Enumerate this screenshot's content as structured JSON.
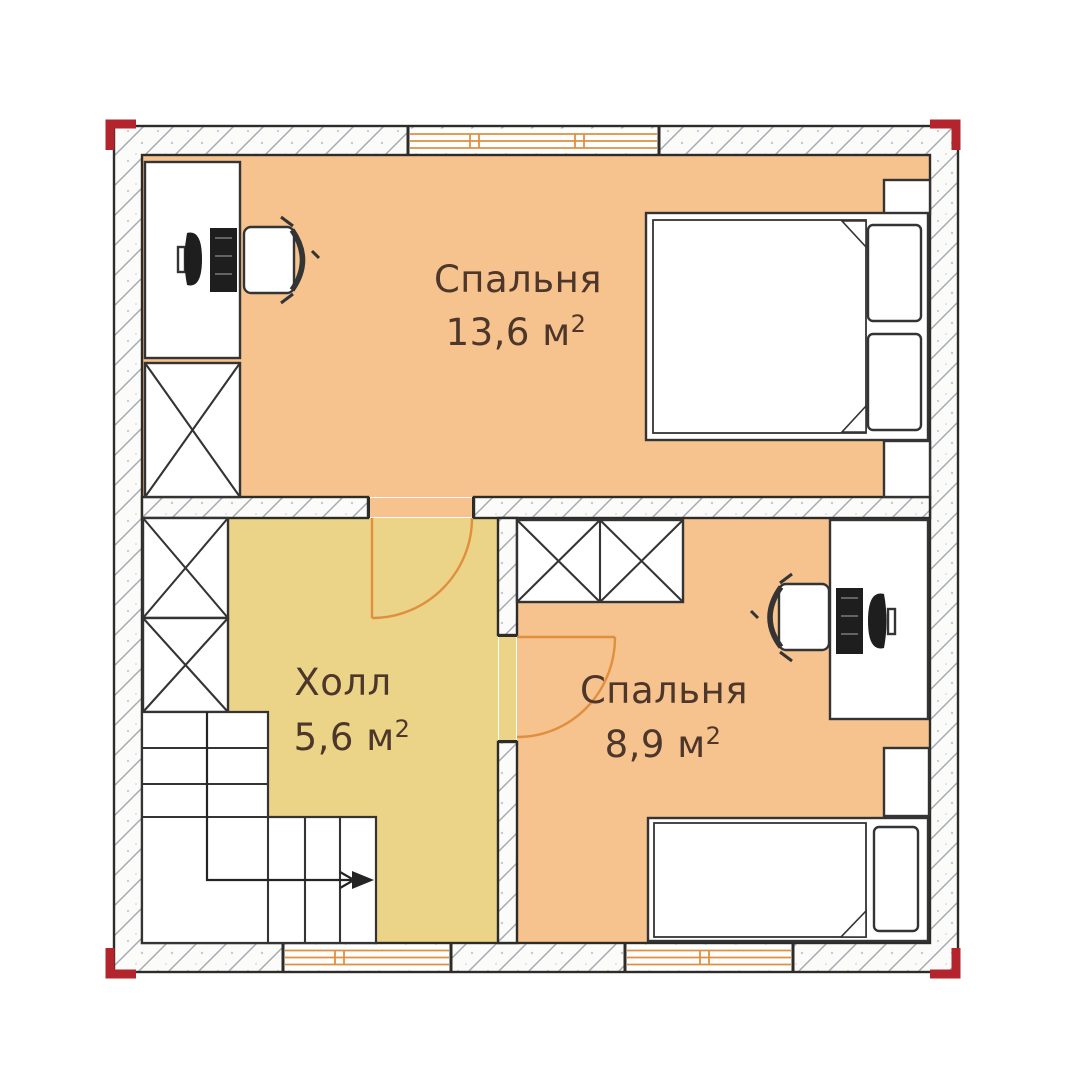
{
  "rooms": {
    "bedroom1": {
      "name": "Спальня",
      "area": "13,6 м",
      "area_sup": "2"
    },
    "hall": {
      "name": "Холл",
      "area": "5,6 м",
      "area_sup": "2"
    },
    "bedroom2": {
      "name": "Спальня",
      "area": "8,9 м",
      "area_sup": "2"
    }
  },
  "colors": {
    "room_fill": "#f6c28d",
    "hall_fill": "#ebd487",
    "accent_orange": "#e08f3f",
    "marker_red": "#b3242c",
    "wall_line": "#2e2c29",
    "furniture_line": "#343434",
    "text_brown": "#4d372b",
    "hatch_line": "#a6abb3",
    "wall_fill": "#fbfbfa"
  },
  "symbols": {
    "double_bed": "double-bed-symbol",
    "single_bed": "single-bed-symbol",
    "desk_computer": "desk-with-computer-symbol",
    "office_chair": "office-chair-symbol",
    "wardrobe": "crossed-box-wardrobe-symbol",
    "stairs": "staircase-with-direction-arrow-symbol",
    "door": "door-swing-symbol",
    "window": "triple-line-window-symbol",
    "corner_marker": "red-corner-marker"
  }
}
